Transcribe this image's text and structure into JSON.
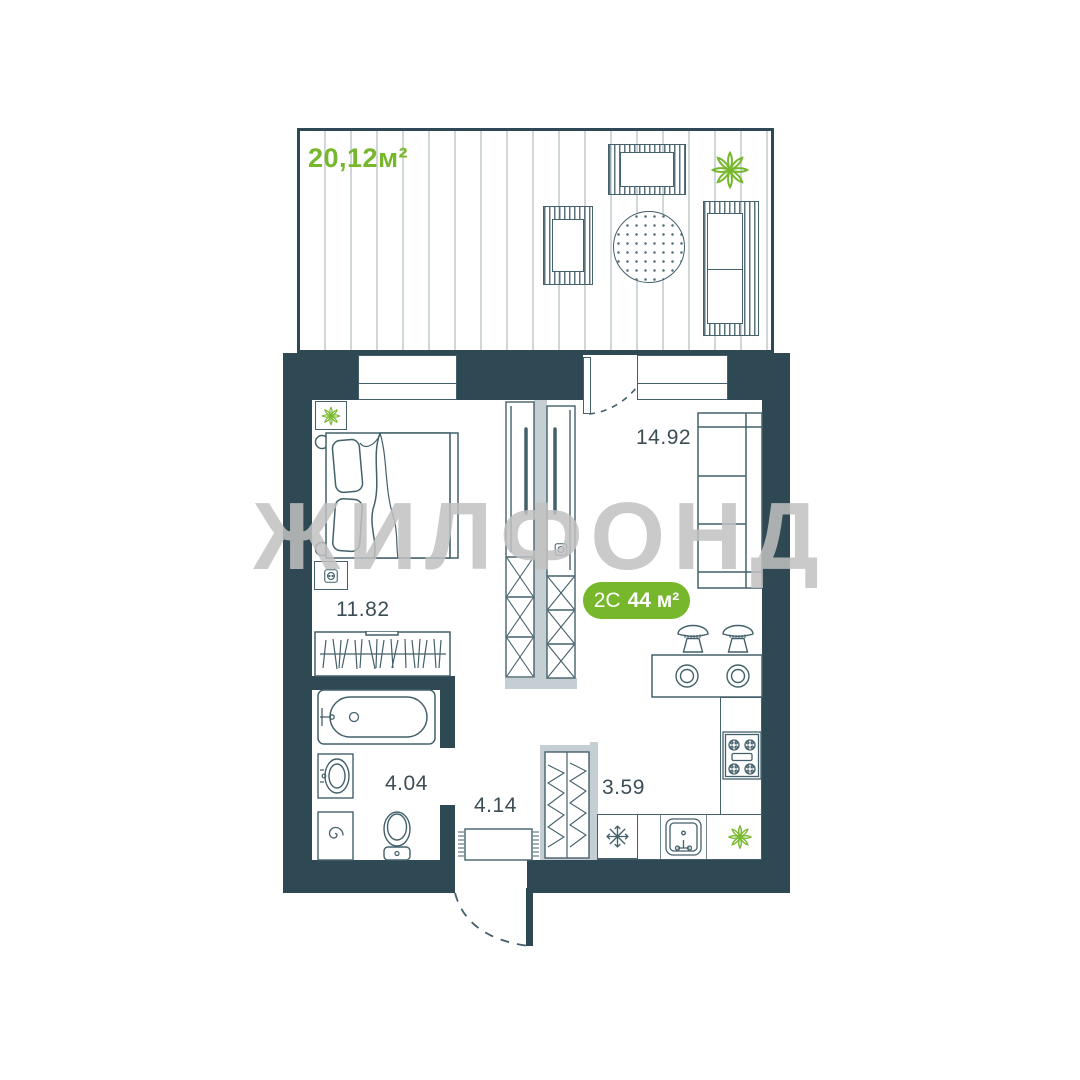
{
  "watermark": "ЖИЛФОНД",
  "terrace": {
    "area_label": "20,12м²"
  },
  "badge": {
    "layout": "2С",
    "area": "44 м²"
  },
  "rooms": {
    "bedroom": "11.82",
    "living_kitchen": "14.92",
    "bathroom": "4.04",
    "hallway": "4.14",
    "kitchen": "3.59"
  },
  "icons": {
    "fridge": "snowflake",
    "washing_machine": "spiral",
    "stove": "gas-burners",
    "plant": "flower",
    "socket": "outlet",
    "table_round": "dotted-circle"
  },
  "colors": {
    "wall_dark": "#2f4954",
    "wall_light": "#c5ced2",
    "outline": "#44606b",
    "accent_green": "#77b72c",
    "watermark_gray": "#c1c1c1"
  }
}
